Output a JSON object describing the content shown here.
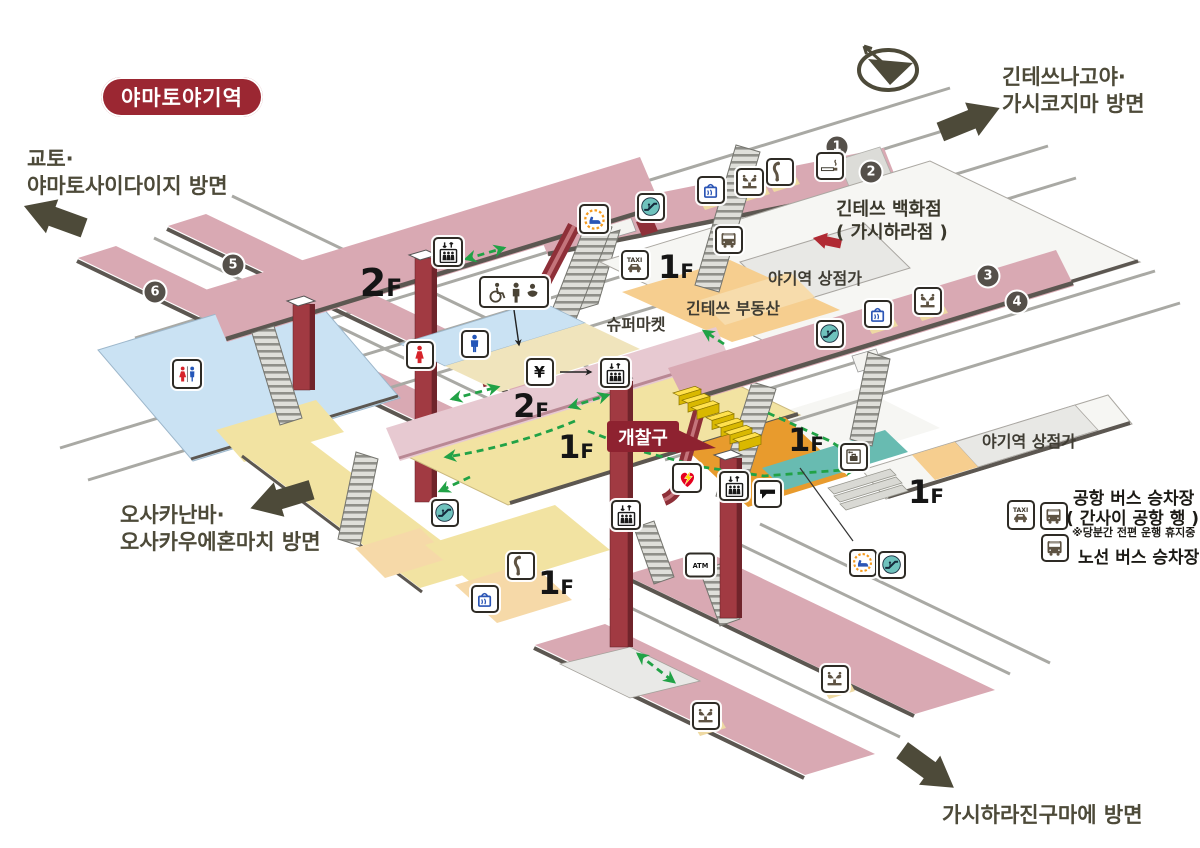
{
  "title_badge": "야마토야기역",
  "gate_label": "개찰구",
  "directions": {
    "northeast": {
      "line1": "긴테쓰나고야·",
      "line2": "가시코지마 방면"
    },
    "northwest": {
      "line1": "교토·",
      "line2": "야마토사이다이지 방면"
    },
    "southwest": {
      "line1": "오사카난바·",
      "line2": "오사카우에혼마치 방면"
    },
    "southeast": {
      "line1": "가시하라진구마에 방면"
    }
  },
  "department_store": {
    "line1": "긴테쓰 백화점",
    "line2": "( 가시하라점 )"
  },
  "legend": {
    "airport_bus_line1": "공항 버스 승차장",
    "airport_bus_line2": "( 간사이 공항 행 )",
    "airport_bus_note": "※당분간 전편 운행 휴지중",
    "local_bus": "노선 버스 승차장"
  },
  "map_lab": [
    {
      "name": "label-yagi-shops-north",
      "text": "야기역 상점가",
      "x": 815,
      "y": 277,
      "s": 16
    },
    {
      "name": "label-kintetsu-fudosan",
      "text": "긴테쓰 부동산",
      "x": 733,
      "y": 307,
      "s": 16
    },
    {
      "name": "label-supermarket",
      "text": "슈퍼마켓",
      "x": 636,
      "y": 323,
      "s": 16
    },
    {
      "name": "label-yagi-shops-east",
      "text": "야기역 상점가",
      "x": 1029,
      "y": 440,
      "s": 16
    }
  ],
  "floor_labels": [
    {
      "name": "floor-label-2f-west",
      "text": "2F",
      "x": 381,
      "y": 283,
      "s": 38
    },
    {
      "name": "floor-label-2f-center",
      "text": "2F",
      "x": 531,
      "y": 406,
      "s": 32
    },
    {
      "name": "floor-label-1f-north",
      "text": "1F",
      "x": 676,
      "y": 267,
      "s": 32
    },
    {
      "name": "floor-label-1f-gate",
      "text": "1F",
      "x": 576,
      "y": 447,
      "s": 32
    },
    {
      "name": "floor-label-1f-mid",
      "text": "1F",
      "x": 806,
      "y": 440,
      "s": 32
    },
    {
      "name": "floor-label-1f-east",
      "text": "1F",
      "x": 926,
      "y": 492,
      "s": 32
    },
    {
      "name": "floor-label-1f-southwest",
      "text": "1F",
      "x": 556,
      "y": 583,
      "s": 32
    }
  ],
  "platform_numbers": [
    {
      "name": "platform-number-1",
      "no": "1",
      "x": 837,
      "y": 147
    },
    {
      "name": "platform-number-2",
      "no": "2",
      "x": 871,
      "y": 172
    },
    {
      "name": "platform-number-3",
      "no": "3",
      "x": 988,
      "y": 276
    },
    {
      "name": "platform-number-4",
      "no": "4",
      "x": 1017,
      "y": 302
    },
    {
      "name": "platform-number-5",
      "no": "5",
      "x": 233,
      "y": 265
    },
    {
      "name": "platform-number-6",
      "no": "6",
      "x": 155,
      "y": 292
    }
  ],
  "icons": [
    {
      "name": "waiting-room-icon",
      "type": "waiting",
      "x": 594,
      "y": 219,
      "w": 30,
      "h": 30
    },
    {
      "name": "escalator-icon-platform12",
      "type": "escalator",
      "x": 651,
      "y": 207
    },
    {
      "name": "kiosk-icon-platform12",
      "type": "bag",
      "x": 711,
      "y": 190
    },
    {
      "name": "fountain-icon-platform12",
      "type": "fountain",
      "x": 750,
      "y": 182
    },
    {
      "name": "phone-icon-platform12",
      "type": "phone",
      "x": 780,
      "y": 172
    },
    {
      "name": "smoking-area-icon",
      "type": "smoking",
      "x": 830,
      "y": 166
    },
    {
      "name": "elevator-icon-2f-west",
      "type": "elevator",
      "x": 448,
      "y": 252,
      "w": 30,
      "h": 30
    },
    {
      "name": "accessible-toilet-icon",
      "type": "accmulti",
      "x": 514,
      "y": 292,
      "w": 70,
      "h": 32
    },
    {
      "name": "mens-toilet-icon",
      "type": "man",
      "x": 475,
      "y": 344
    },
    {
      "name": "womens-toilet-icon",
      "type": "woman",
      "x": 420,
      "y": 355
    },
    {
      "name": "ticket-machine-icon",
      "type": "yen",
      "x": 540,
      "y": 372
    },
    {
      "name": "elevator-icon-2f-center",
      "type": "elevator",
      "x": 615,
      "y": 373,
      "w": 30,
      "h": 30
    },
    {
      "name": "taxi-stand-icon-north",
      "type": "taxi",
      "x": 635,
      "y": 265,
      "w": 28,
      "h": 30
    },
    {
      "name": "bus-stop-icon-north",
      "type": "bus",
      "x": 729,
      "y": 240
    },
    {
      "name": "escalator-icon-platform34",
      "type": "escalator",
      "x": 830,
      "y": 334
    },
    {
      "name": "kiosk-icon-platform34",
      "type": "bag",
      "x": 878,
      "y": 314
    },
    {
      "name": "fountain-icon-platform34",
      "type": "fountain",
      "x": 928,
      "y": 301
    },
    {
      "name": "unisex-toilet-icon",
      "type": "unisex",
      "x": 187,
      "y": 374,
      "w": 30,
      "h": 30
    },
    {
      "name": "aed-icon",
      "type": "aed",
      "x": 687,
      "y": 478,
      "w": 30,
      "h": 30
    },
    {
      "name": "elevator-icon-1f-center",
      "type": "elevator",
      "x": 626,
      "y": 515,
      "w": 30,
      "h": 30
    },
    {
      "name": "elevator-icon-1f-east",
      "type": "elevator",
      "x": 734,
      "y": 486,
      "w": 30,
      "h": 30
    },
    {
      "name": "ticket-window-icon",
      "type": "window",
      "x": 768,
      "y": 494
    },
    {
      "name": "coin-locker-icon",
      "type": "locker",
      "x": 854,
      "y": 457
    },
    {
      "name": "waiting-room-icon-1f",
      "type": "waiting",
      "x": 863,
      "y": 563
    },
    {
      "name": "escalator-icon-1f",
      "type": "escalator",
      "x": 892,
      "y": 565
    },
    {
      "name": "atm-icon",
      "type": "atm",
      "x": 700,
      "y": 565,
      "w": 30,
      "h": 25
    },
    {
      "name": "phone-icon-southwest",
      "type": "phone",
      "x": 521,
      "y": 566
    },
    {
      "name": "kiosk-icon-southwest",
      "type": "bag",
      "x": 485,
      "y": 599
    },
    {
      "name": "escalator-icon-southwest",
      "type": "escalator",
      "x": 445,
      "y": 513
    },
    {
      "name": "fountain-icon-platform-south-a",
      "type": "fountain",
      "x": 706,
      "y": 716
    },
    {
      "name": "fountain-icon-platform-south-b",
      "type": "fountain",
      "x": 835,
      "y": 679
    },
    {
      "name": "taxi-stand-icon-legend",
      "type": "taxi",
      "x": 1021,
      "y": 515,
      "w": 28,
      "h": 30
    },
    {
      "name": "bus-stop-icon-airport",
      "type": "bus",
      "x": 1054,
      "y": 516
    },
    {
      "name": "bus-stop-icon-local",
      "type": "bus",
      "x": 1055,
      "y": 548
    }
  ],
  "colors": {
    "badge_red": "#9b2732",
    "gate_red": "#8e2230",
    "platform_pink": "#d9a9b3",
    "bridge_pink": "#e7c9d1",
    "floor_yellow": "#f2e3a2",
    "office_orange": "#e89b2d",
    "walkway_teal": "#68bbb1",
    "toilet_blue": "#cae2f3",
    "route_green": "#21a246",
    "ink_olive": "#4d4a39",
    "gate_yellow": "#ffe14d"
  }
}
